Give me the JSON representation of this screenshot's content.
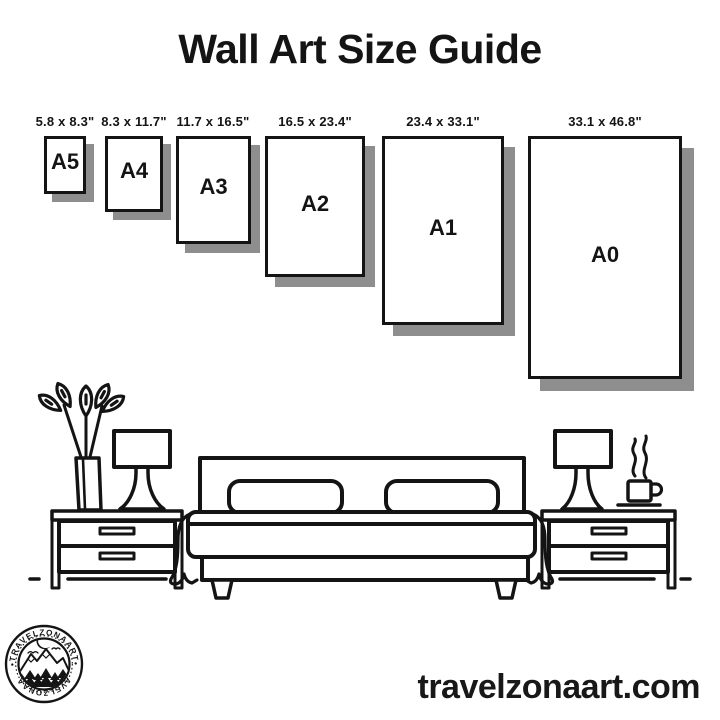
{
  "title": "Wall Art Size Guide",
  "colors": {
    "ink": "#141414",
    "shadow": "#8e8e8e",
    "background": "#ffffff"
  },
  "sizes": [
    {
      "name": "A5",
      "dimensions": "5.8 x 8.3\""
    },
    {
      "name": "A4",
      "dimensions": "8.3 x 11.7\""
    },
    {
      "name": "A3",
      "dimensions": "11.7 x 16.5\""
    },
    {
      "name": "A2",
      "dimensions": "16.5 x 23.4\""
    },
    {
      "name": "A1",
      "dimensions": "23.4 x 33.1\""
    },
    {
      "name": "A0",
      "dimensions": "33.1 x 46.8\""
    }
  ],
  "logo": {
    "brand": "TRAVELZONAART",
    "arc_text_top": "•TRAVELZONAART•",
    "arc_text_bottom": "•TRAVELZONAART•"
  },
  "footer": {
    "website": "travelzonaart.com"
  },
  "illustration": {
    "scene": "bedroom",
    "items": [
      "potted-plant",
      "table-lamp-left",
      "nightstand-left",
      "double-bed",
      "pillow-left",
      "pillow-right",
      "nightstand-right",
      "table-lamp-right",
      "coffee-cup"
    ]
  }
}
